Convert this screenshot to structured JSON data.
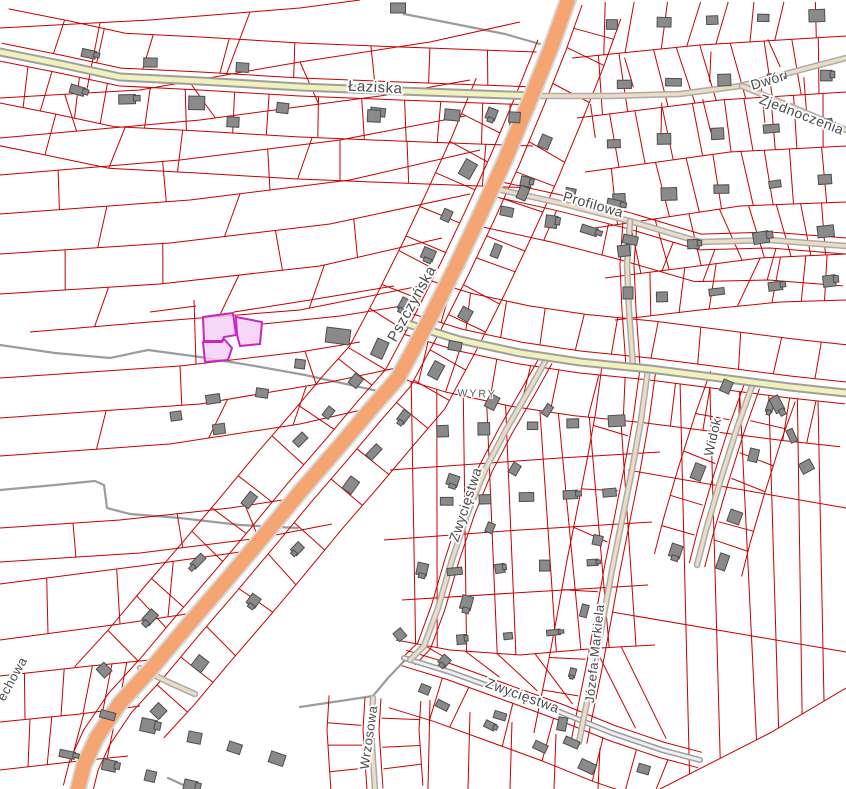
{
  "map": {
    "labels": [
      {
        "id": "laziska",
        "text": "Łaziska",
        "kind": "street"
      },
      {
        "id": "dwor",
        "text": "Dwór",
        "kind": "street"
      },
      {
        "id": "zjednoczenia",
        "text": "Zjednoczenia",
        "kind": "street"
      },
      {
        "id": "profilowa",
        "text": "Profilowa",
        "kind": "street"
      },
      {
        "id": "pszczynska",
        "text": "Pszczyńska",
        "kind": "street"
      },
      {
        "id": "wyry",
        "text": "WYRY",
        "kind": "locality"
      },
      {
        "id": "zwyciestwa-mid",
        "text": "Zwycięstwa",
        "kind": "street"
      },
      {
        "id": "widok",
        "text": "Widok",
        "kind": "street"
      },
      {
        "id": "jozefa-markiela",
        "text": "Józefa-Markiela",
        "kind": "street"
      },
      {
        "id": "zwyciestwa-bottom",
        "text": "Zwycięstwa",
        "kind": "street"
      },
      {
        "id": "wrzosowa",
        "text": "Wrzosowa",
        "kind": "street"
      },
      {
        "id": "echowa-partial",
        "text": "echowa",
        "kind": "street"
      }
    ],
    "palette": {
      "parcel_line": "#C80000",
      "building": "#8A8A8A",
      "road_main": "#F5A571",
      "road_secondary": "#F1F1BC",
      "road_minor": "#EBDCC3",
      "road_gray": "#9C9C9C",
      "highlight_fill": "#F4CDF4",
      "highlight_stroke": "#C428C4",
      "label_color": "#4A4A4A",
      "background": "#FFFFFF"
    },
    "selection": {
      "highlighted_parcels": 3
    }
  }
}
